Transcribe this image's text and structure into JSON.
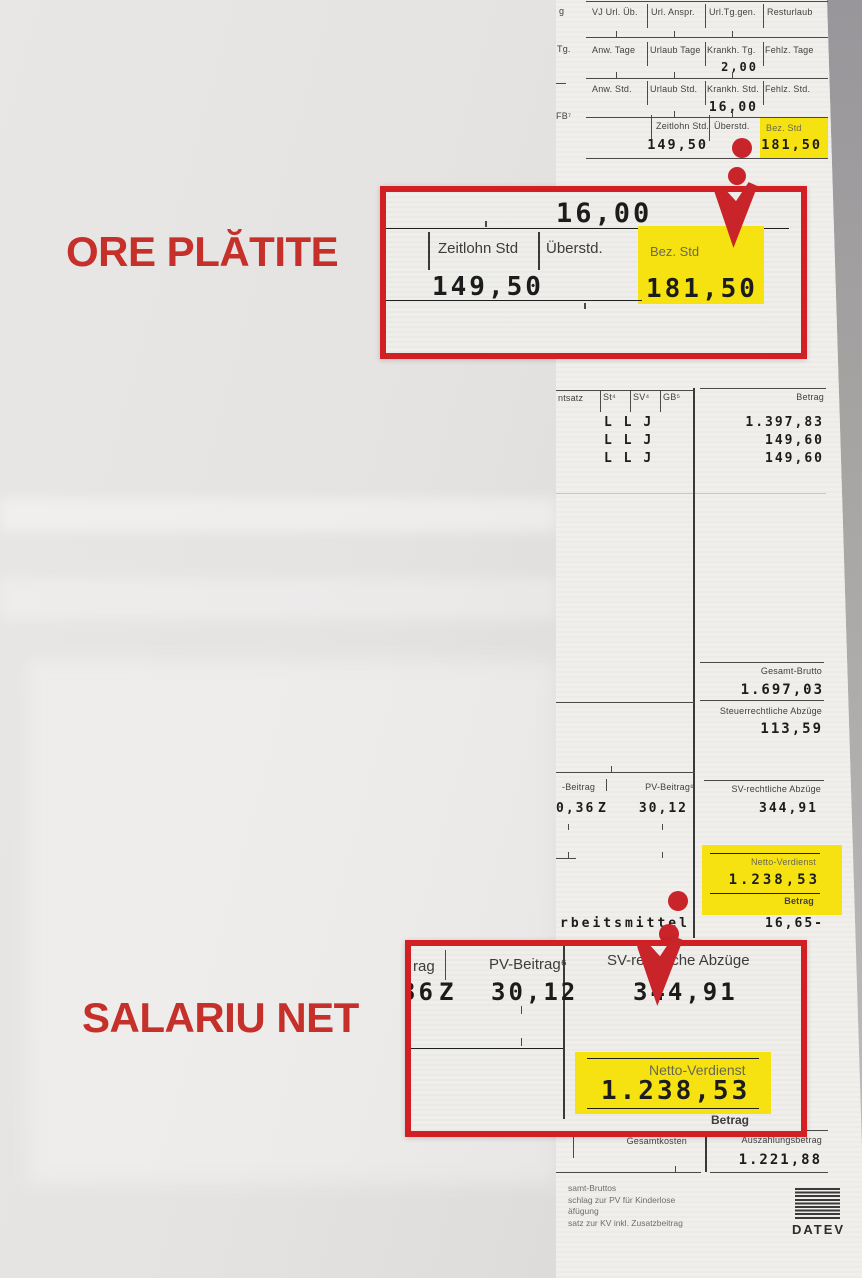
{
  "annotations": {
    "hours_label": "ORE PLĂTITE",
    "net_label": "SALARIU NET",
    "accent_red": "#c5302a",
    "callout_border_red": "#d21f24",
    "highlight_yellow": "#f6e211"
  },
  "payslip": {
    "top_table": {
      "row1": {
        "stub": "g",
        "c1": "VJ Url. Üb.",
        "c2": "Url. Anspr.",
        "c3": "Url.Tg.gen.",
        "c4": "Resturlaub"
      },
      "row2": {
        "stub": "Tg.",
        "c1": "Anw. Tage",
        "c2": "Urlaub Tage",
        "c3": "Krankh. Tg.",
        "c4": "Fehlz. Tage",
        "value": "2,00"
      },
      "row3": {
        "c1": "Anw. Std.",
        "c2": "Urlaub Std.",
        "c3": "Krankh. Std.",
        "c4": "Fehlz. Std.",
        "value": "16,00"
      },
      "row4": {
        "stub": "FB⁷",
        "c1": "Zeitlohn Std.",
        "c2": "Überstd.",
        "c3": "Bez. Std",
        "zeitlohn_value": "149,50",
        "bez_value": "181,50"
      }
    },
    "earnings_table": {
      "col_left": "ntsatz",
      "col_st": "St⁴",
      "col_sv": "SV⁴",
      "col_gb": "GB⁵",
      "col_betrag": "Betrag",
      "rows": [
        {
          "st": "L",
          "sv": "L",
          "gb": "J",
          "betrag": "1.397,83"
        },
        {
          "st": "L",
          "sv": "L",
          "gb": "J",
          "betrag": "149,60"
        },
        {
          "st": "L",
          "sv": "L",
          "gb": "J",
          "betrag": "149,60"
        }
      ]
    },
    "totals": {
      "gesamt_brutto_label": "Gesamt-Brutto",
      "gesamt_brutto": "1.697,03",
      "steuer_label": "Steuerrechtliche Abzüge",
      "steuer": "113,59",
      "kv_label": "-Beitrag",
      "kv_value": "0,36",
      "kv_flag": "Z",
      "pv_label": "PV-Beitrag⁶",
      "pv_value": "30,12",
      "sv_label": "SV-rechtliche Abzüge",
      "sv_value": "344,91",
      "netto_label": "Netto-Verdienst",
      "netto": "1.238,53",
      "betrag_label": "Betrag",
      "arbeitsmittel_label": "rbeitsmittel",
      "arbeitsmittel_value": "16,65-",
      "gesamtkosten_label": "Gesamtkosten",
      "auszahlung_label": "Auszahlungsbetrag",
      "auszahlung": "1.221,88"
    },
    "footnotes": [
      "samt-Bruttos",
      "schlag zur PV für Kinderlose",
      "äfügung",
      "satz zur KV inkl. Zusatzbeitrag"
    ],
    "logo_text": "DATEV"
  },
  "callout_hours": {
    "top_value": "16,00",
    "col1": "Zeitlohn Std",
    "col2": "Überstd.",
    "col3": "Bez. Std",
    "value1": "149,50",
    "value3": "181,50"
  },
  "callout_net": {
    "col1": "rag",
    "col2": "PV-Beitrag⁶",
    "col3": "SV-rechtliche Abzüge",
    "value1": "36",
    "value1_flag": "Z",
    "value2": "30,12",
    "value3": "344,91",
    "netto_label": "Netto-Verdienst",
    "netto": "1.238,53",
    "betrag_label": "Betrag"
  }
}
